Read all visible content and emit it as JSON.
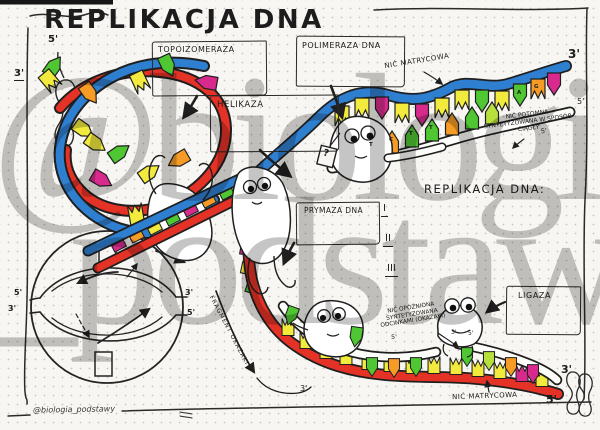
{
  "title": "REPLIKACJA DNA",
  "watermark": {
    "line1": "@biologia",
    "line2": "_podstawy"
  },
  "signature": "@biologia_podstawy",
  "boxes": {
    "topoisomerase": "TOPOIZOMERAZA",
    "polymerase": "POLIMERAZA DNA",
    "helicase": "HELIKAZA",
    "primase": "PRYMAZA DNA",
    "ligase": "LIGAZA"
  },
  "annotations": {
    "template_strand_top": "NIĆ MATRYCOWA",
    "leading_line1": "NIĆ POTOMNA",
    "leading_line2": "SYNTETYZOWANA W SPOSÓB",
    "leading_line3": "CIĄGŁY",
    "lagging_line1": "NIĆ OPÓŹNIONA",
    "lagging_line2": "SYNTETYZOWANA",
    "lagging_line3": "ODCINKAMI (OKAZAKI)",
    "template_strand_bottom": "NIĆ MATRYCOWA",
    "okazaki_fragment": "FRAGMENT OKAZAKI",
    "question_tag": "?"
  },
  "notes_list": {
    "heading": "REPLIKACJA DNA:",
    "items": [
      "I",
      "II",
      "III"
    ]
  },
  "ends": {
    "five": "5'",
    "three": "3'"
  },
  "bases": {
    "letters": [
      "T",
      "C",
      "T",
      "T",
      "A",
      "G"
    ]
  },
  "colors": {
    "paper": "#f7f6f2",
    "ink": "#1f1f1f",
    "strand_blue": "#2e7fd0",
    "strand_red": "#e53226",
    "base_green": "#4fc732",
    "base_yellow": "#f2ea3d",
    "base_orange": "#f59b26",
    "base_magenta": "#d82a8d",
    "base_lime": "#b8e03c",
    "watermark_gray": "#8c8c8c"
  }
}
